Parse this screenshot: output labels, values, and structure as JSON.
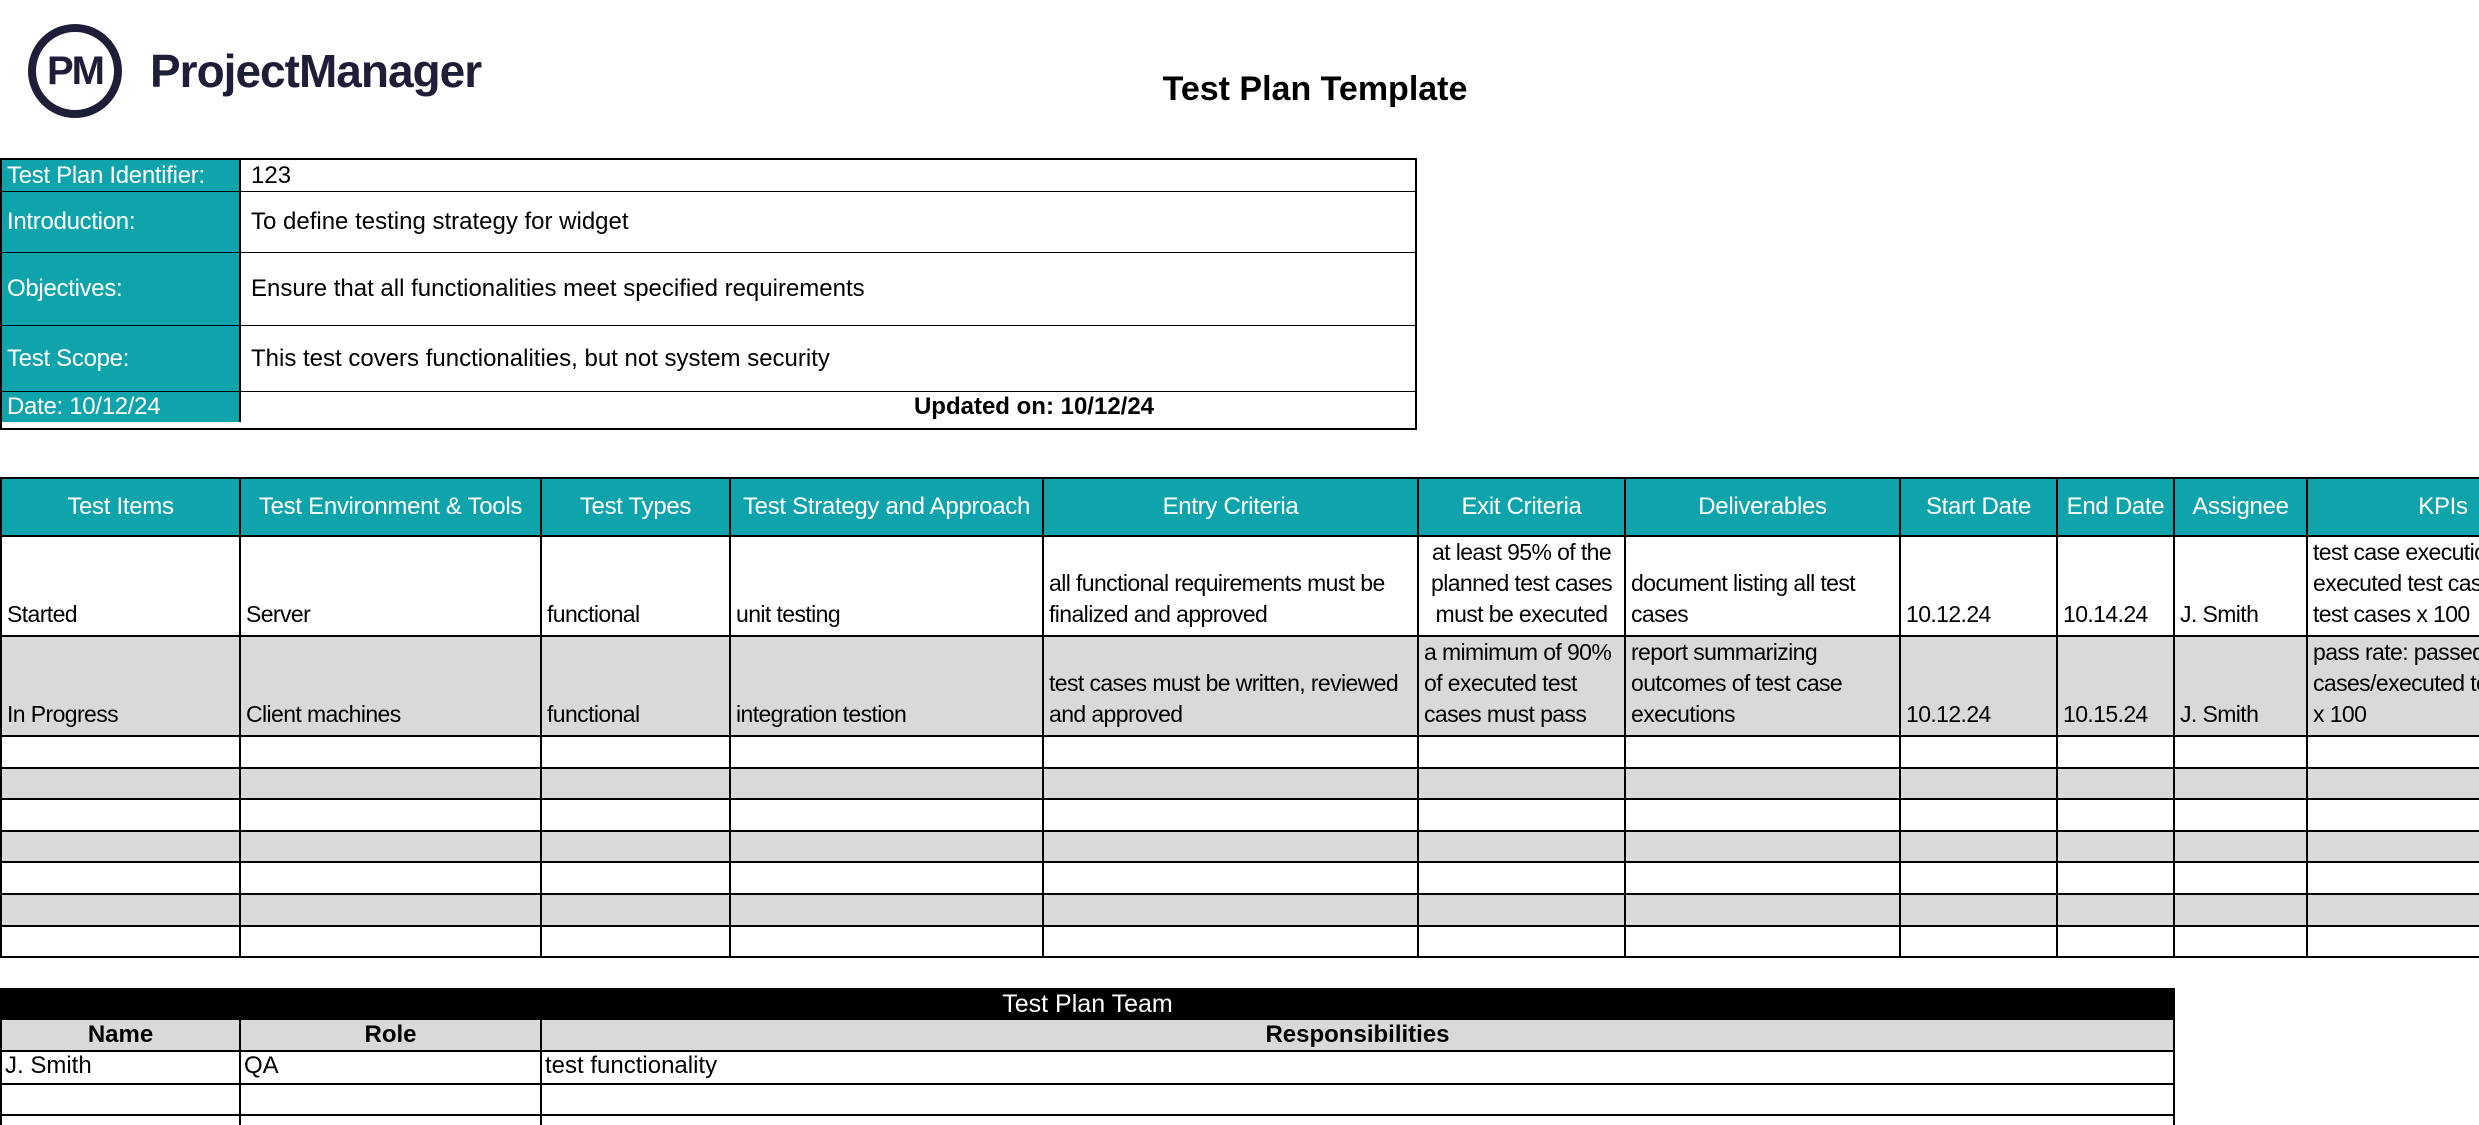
{
  "brand": {
    "logo_monogram": "PM",
    "name": "ProjectManager"
  },
  "title": "Test Plan Template",
  "colors": {
    "teal": "#0FA3AB",
    "row_gray": "#D9D9D9",
    "navy": "#1E1E38",
    "bar_black": "#000000"
  },
  "info_table": {
    "rows": [
      {
        "label": "Test Plan Identifier:",
        "value": "123"
      },
      {
        "label": "Introduction:",
        "value": "To define testing strategy for widget"
      },
      {
        "label": "Objectives:",
        "value": "Ensure that all functionalities meet specified requirements"
      },
      {
        "label": "Test Scope:",
        "value": "This test covers functionalities, but not system security"
      },
      {
        "label": "Date: 10/12/24",
        "value": "Updated on: 10/12/24"
      }
    ]
  },
  "main_table": {
    "headers": [
      "Test Items",
      "Test Environment & Tools",
      "Test Types",
      "Test Strategy and Approach",
      "Entry Criteria",
      "Exit Criteria",
      "Deliverables",
      "Start Date",
      "End Date",
      "Assignee",
      "KPIs"
    ],
    "rows": [
      {
        "test_items": "Started",
        "environment": "Server",
        "test_types": "functional",
        "strategy": "unit testing",
        "entry_criteria": "all functional requirements must be\nfinalized and approved",
        "exit_criteria": "at least 95% of the\nplanned test cases\nmust be executed",
        "deliverables": "document listing all test\ncases",
        "start_date": "10.12.24",
        "end_date": "10.14.24",
        "assignee": "J. Smith",
        "kpis": "test case execution:\nexecuted test cases/total\ntest cases x 100"
      },
      {
        "test_items": "In Progress",
        "environment": "Client machines",
        "test_types": "functional",
        "strategy": "integration testion",
        "entry_criteria": "test cases must be written, reviewed\nand approved",
        "exit_criteria": "a mimimum of 90%\nof executed test\ncases must pass",
        "deliverables": "report summarizing\noutcomes of test case\nexecutions",
        "start_date": "10.12.24",
        "end_date": "10.15.24",
        "assignee": "J. Smith",
        "kpis": "pass rate: passed test\ncases/executed test cases\nx 100"
      }
    ],
    "empty_row_count": 7
  },
  "team_table": {
    "title": "Test Plan Team",
    "headers": [
      "Name",
      "Role",
      "Responsibilities"
    ],
    "rows": [
      {
        "name": "J. Smith",
        "role": "QA",
        "responsibilities": "test functionality"
      }
    ],
    "empty_row_count": 2
  }
}
